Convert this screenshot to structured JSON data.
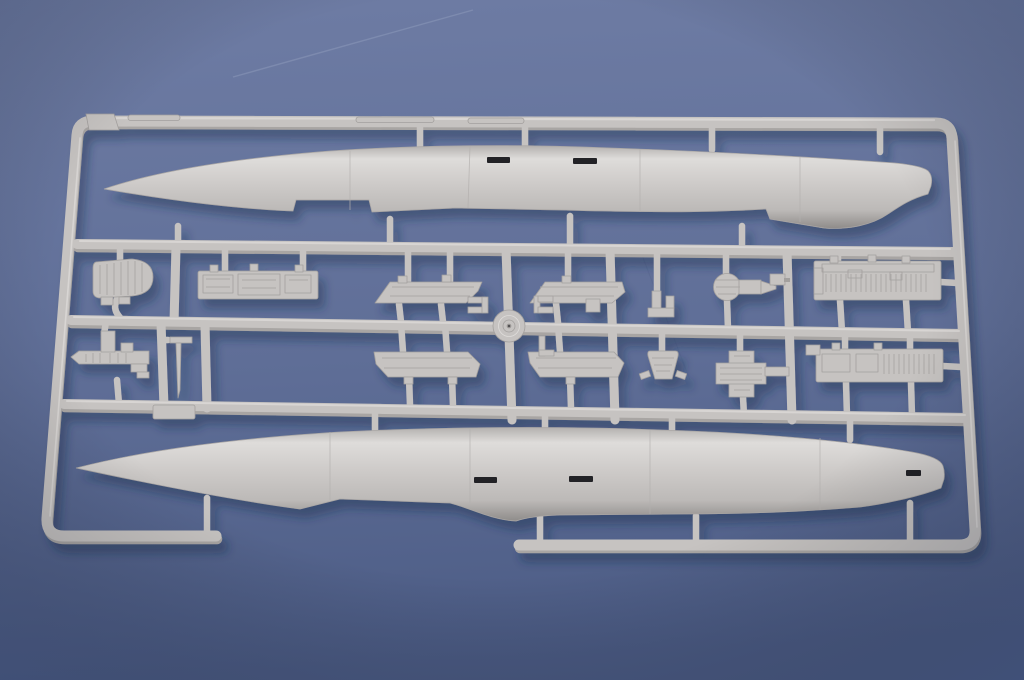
{
  "scene": {
    "subject": "Photograph of a gray injection-molded plastic model kit sprue (parts tree) lying on a blue-gray background",
    "content": "Two long aircraft/missile fuselage halves (noses pointing left) molded at top and bottom of a rectangular runner frame, with two middle rows of small parts: seat pack, instrument panel, console, pitot probe, four flat wing panels, a round hub disc, a small bracket, a fan/turbine unit, a nozzle bucket, a textured cross block and two ribbed equipment-bay boxes",
    "visible_text": ""
  },
  "colors": {
    "background_top": "#6e7ca4",
    "background_bottom": "#4c5c85",
    "vignette": "#2e3d63",
    "plastic_base": "#c6c3c1",
    "plastic_outline": "#a3a09e",
    "plastic_highlight": "#dedcda",
    "plastic_shade": "#a8a5a3",
    "plastic_deep": "#8f8c8a",
    "slot_dark": "#232327",
    "cast_shadow": "#1d2c4f",
    "scratch": "#93a0bf"
  },
  "sprue": {
    "frame": "open rectangular runner frame with rounded corners",
    "horizontal_runners": 5,
    "parts": {
      "upper_fuselage": "fuselage half, nose left, tail fairing right",
      "lower_fuselage": "fuselage half, nose left, intake fairing under mid-body",
      "seat_pack": "ribbed D-shaped seat/parachute pack",
      "instrument_panel": "long rectangular cockpit panel with sub-panels",
      "console": "stepped console rail with upright tab",
      "pitot_probe": "thin blade probe with crossbar",
      "wing_panel_1": "flat swept panel, upper left",
      "wing_panel_2": "flat swept panel, upper right",
      "wing_panel_3": "flat swept panel, lower left",
      "wing_panel_4": "flat swept panel, lower right",
      "hub_disc": "round hub with concentric rings at runner crossing",
      "bracket": "small L-bracket",
      "fan_unit": "round finned unit with cone nozzle",
      "nozzle_bucket": "tapered bucket with side arms",
      "cross_block": "plus-shaped textured block",
      "equipment_bay_1": "long ribbed equipment bay box, upper right",
      "equipment_bay_2": "long ribbed equipment bay box, lower right",
      "molding_tag": "small molded tag plate on lower runner"
    }
  }
}
